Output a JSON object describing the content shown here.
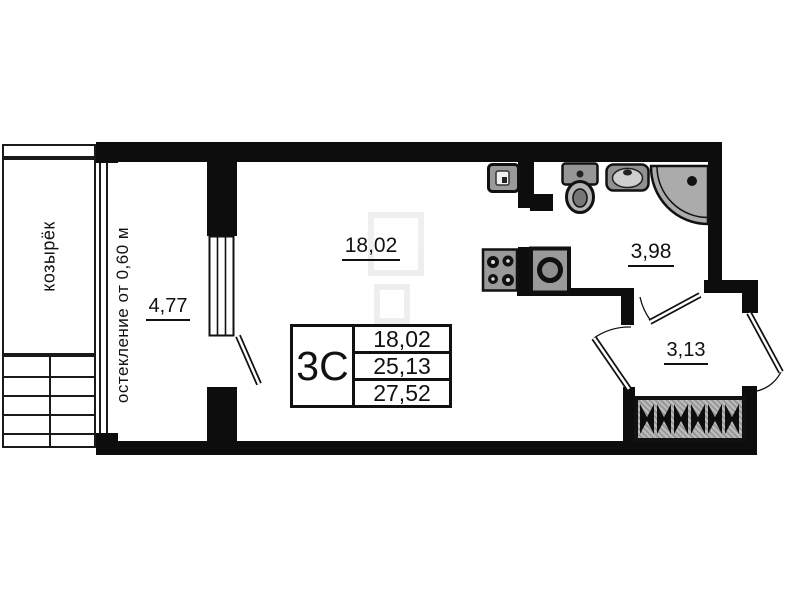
{
  "plan": {
    "background": "#ffffff",
    "wall_color": "#0d0d0d",
    "fixture_fill": "#9a9a9a",
    "labels": {
      "canopy": "козырёк",
      "glazing": "остекление от 0,60 м",
      "living_area": "18,02",
      "balcony_area": "4,77",
      "bathroom_area": "3,98",
      "hall_area": "3,13"
    },
    "info_table": {
      "unit_type": "3С",
      "areas": [
        "18,02",
        "25,13",
        "27,52"
      ]
    },
    "fixtures": [
      "washing-machine",
      "toilet",
      "wash-basin",
      "corner-shower",
      "stove",
      "kitchen-sink",
      "wardrobe",
      "stairs",
      "balcony-window",
      "balcony-door",
      "room-door",
      "bathroom-door",
      "entrance-door"
    ]
  }
}
